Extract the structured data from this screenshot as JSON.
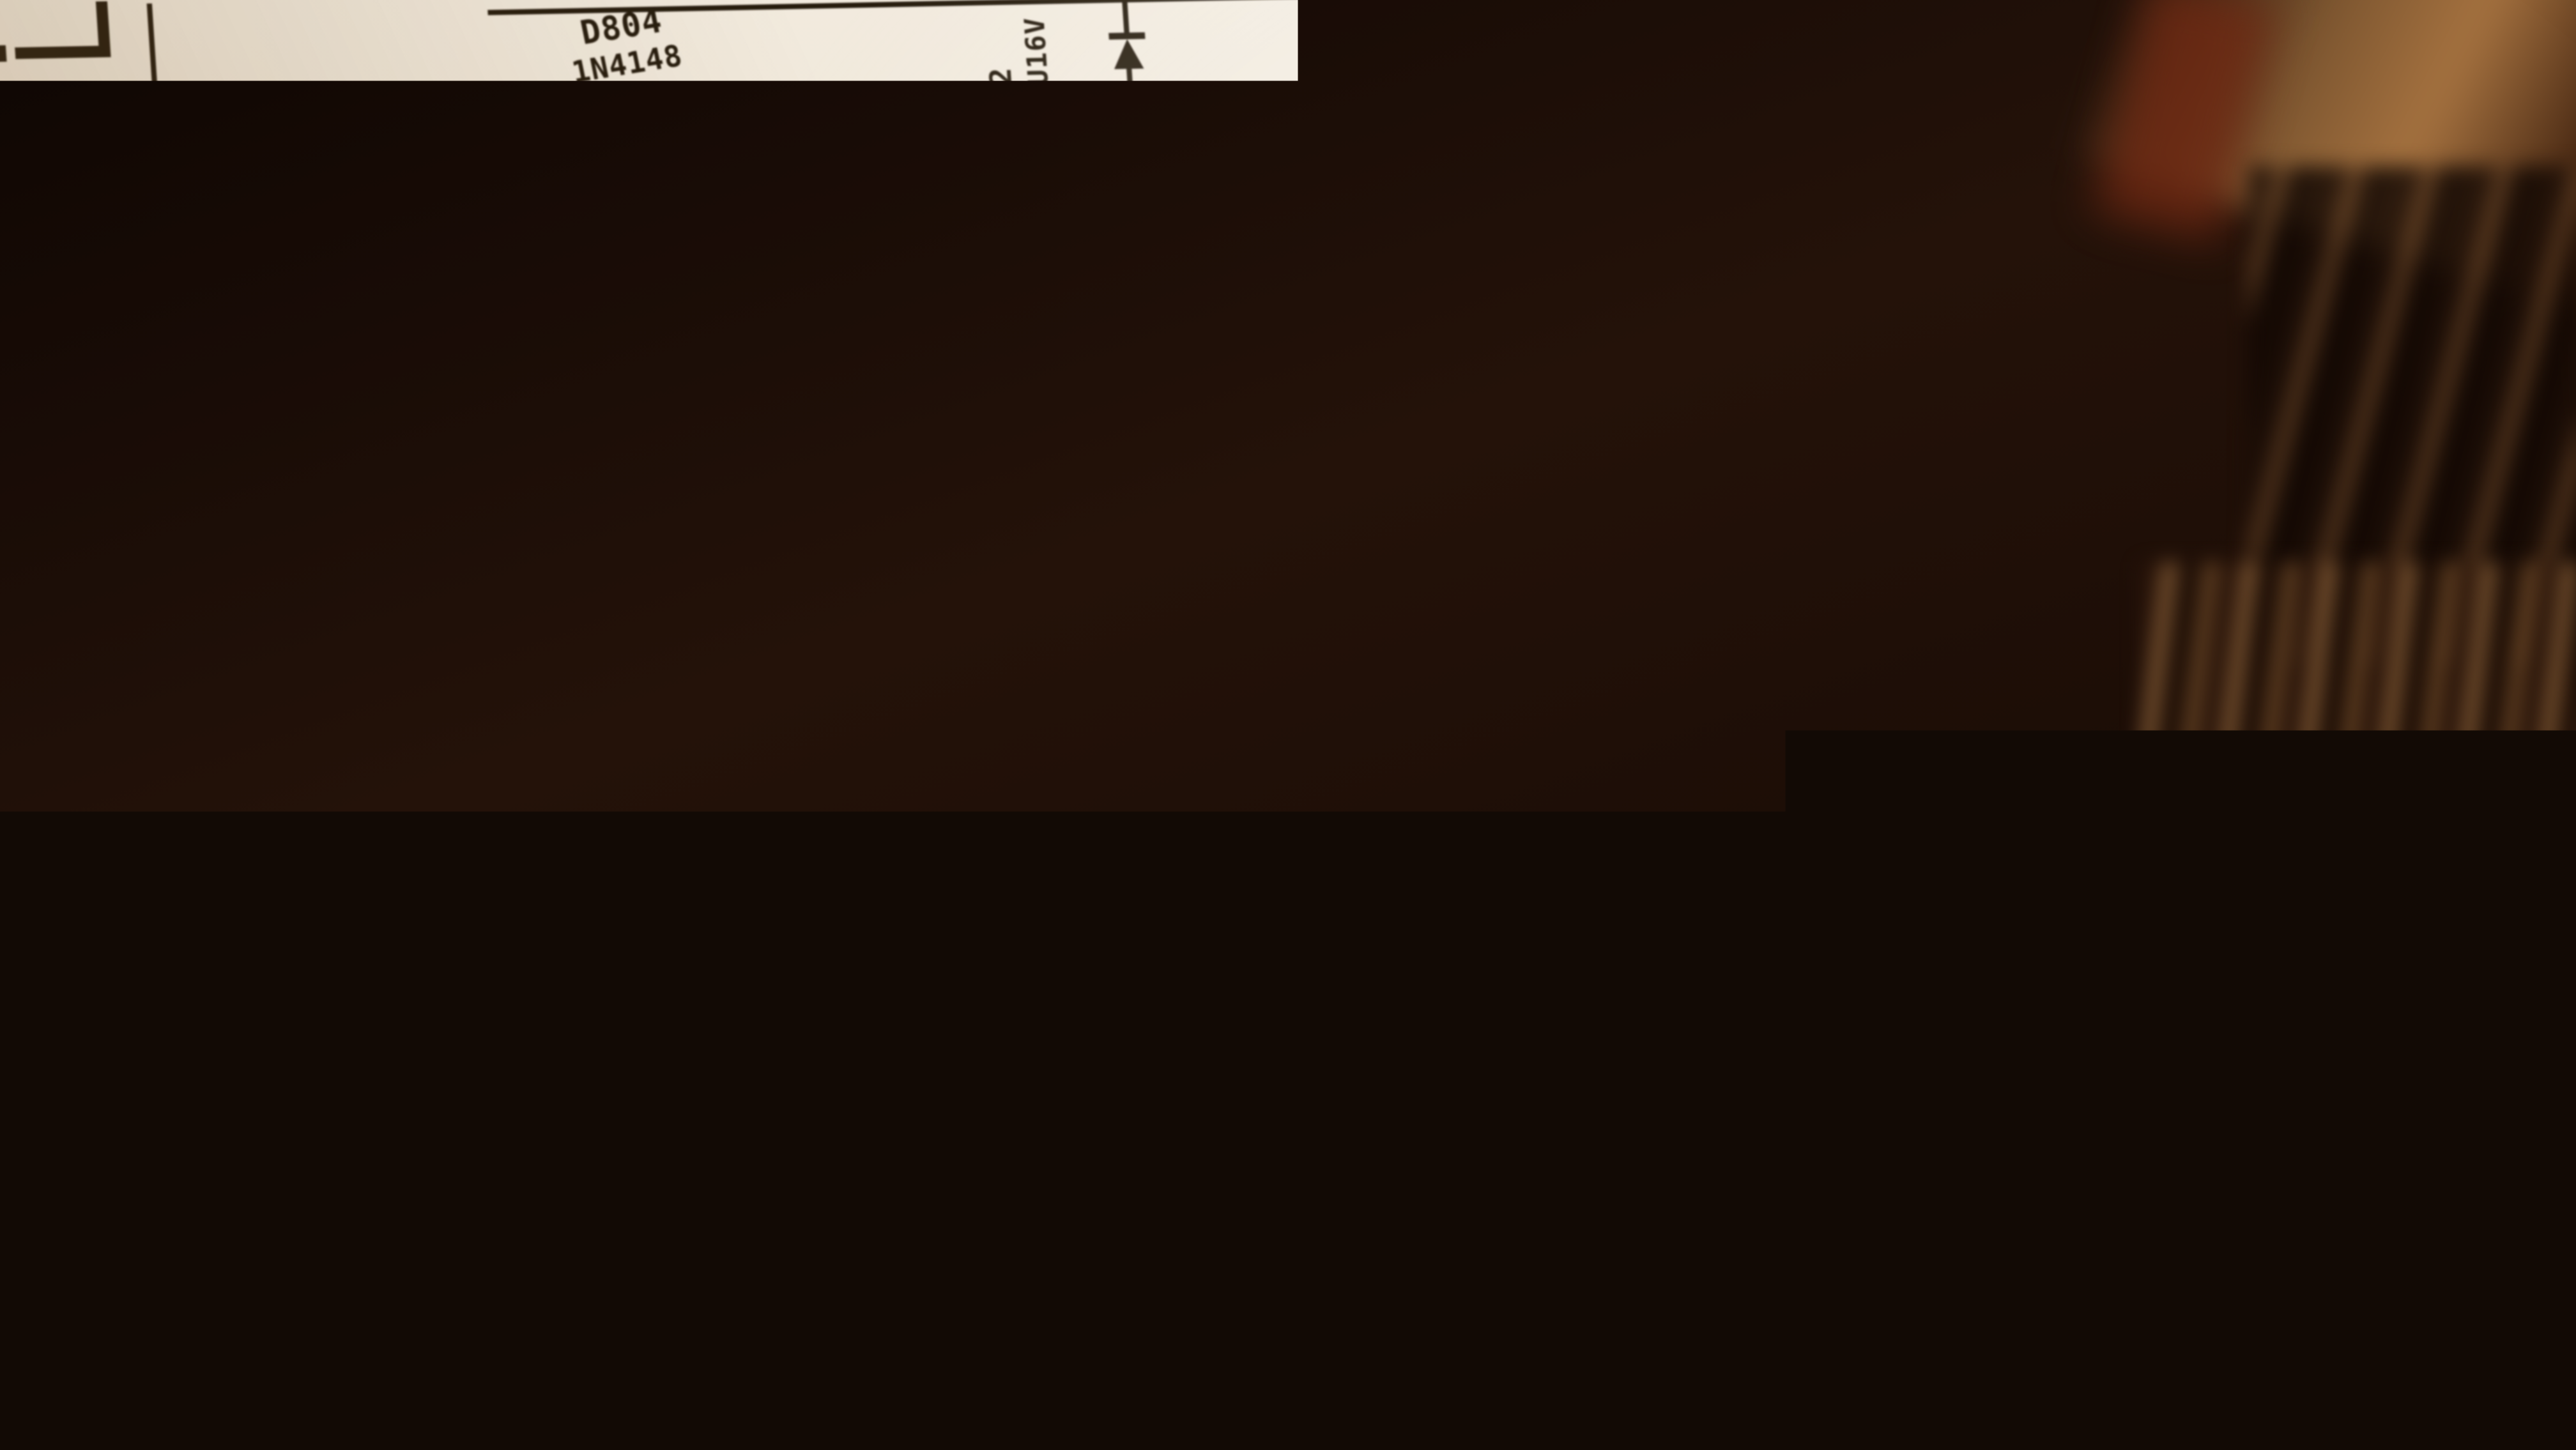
{
  "scene": {
    "description": "Photograph of a printed amplifier power-supply schematic on a tilted white sheet of paper lying on a dark red-brown patterned carpet",
    "paper_color": "#f0e8dc",
    "ink_color": "#251a10",
    "carpet_dark": "#160b05",
    "carpet_brown": "#6f4a28",
    "carpet_orange": "#b5501f",
    "carpet_tan": "#8a6a42"
  },
  "schematic": {
    "labels": {
      "d804_ref": "D804",
      "d804_value": "1N4148",
      "c802_ref": "C802",
      "c802_value": "100U16V",
      "zd802_ref": "ZD802",
      "r804_ref": "R804",
      "r804_value": "3K3",
      "r802_ref": "R802",
      "r802_value": "220/1W",
      "d808_ref": "D808",
      "d808_value": "14V/0.5W",
      "d808_polarity": "+",
      "c804_ref": "C804",
      "c804_value": "220U16V",
      "fuse1_label": "FUSE 5A",
      "d801_ref": "D801",
      "c805_ref": "C805",
      "c805_value": "6.8UF/500V",
      "d802_ref": "D802",
      "c806_ref": "C806",
      "c806_value": "6.8UF/500V",
      "fuse2_label": "FUSE 5A",
      "diode_array_value": "402x4",
      "relay_cap_value": "472(VOE)",
      "relay_ref": "RY3",
      "speaker_ref": "VOE"
    }
  }
}
